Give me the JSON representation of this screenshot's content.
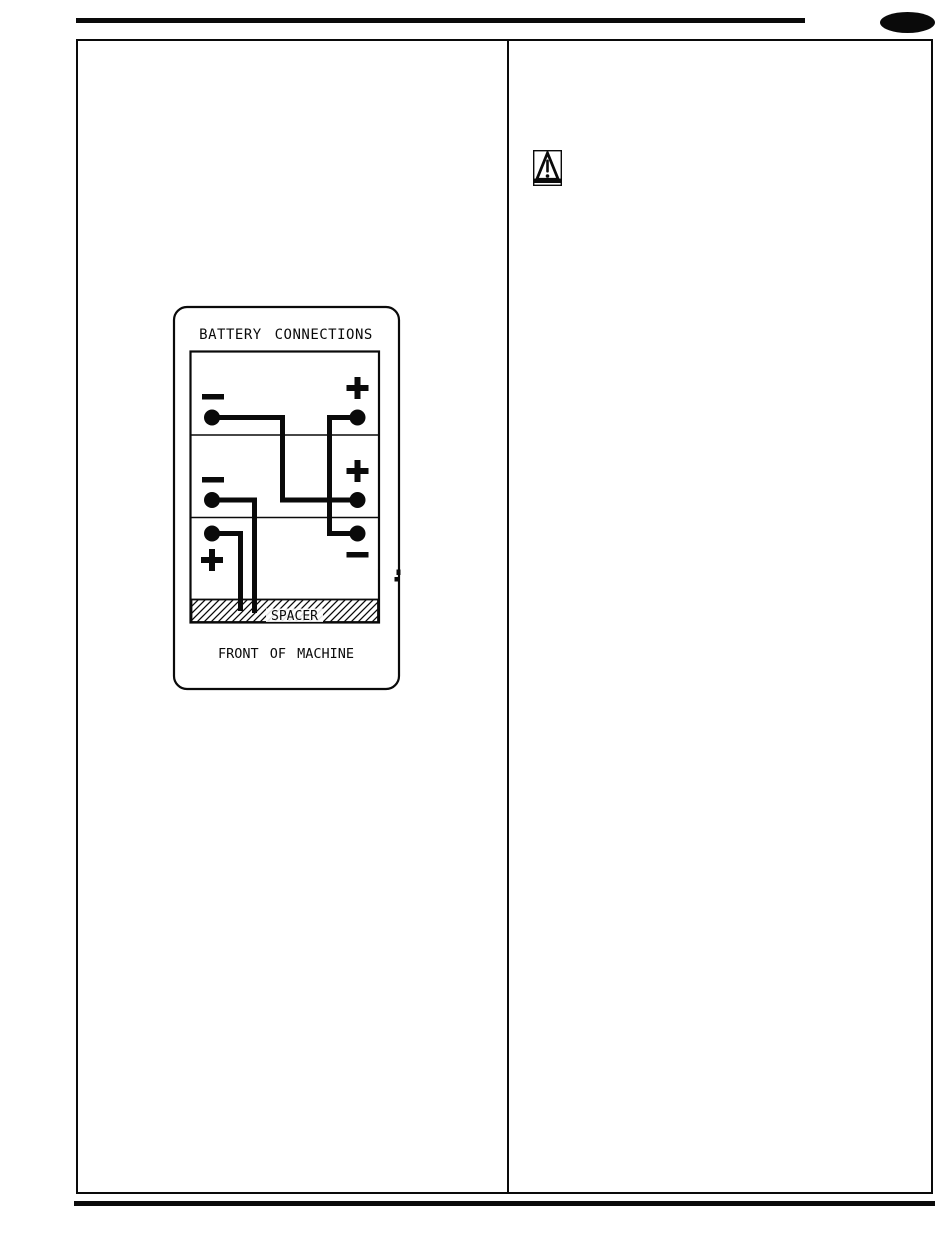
{
  "page": {
    "kind": "scanned manual page",
    "background_color": "#ffffff",
    "ink_color": "#0a0a0a"
  },
  "header": {
    "rule": "thick horizontal line",
    "page_marker_icon": "filled-ellipse"
  },
  "footer": {
    "rule": "thick horizontal line"
  },
  "layout": {
    "columns": 2,
    "left_column_content": "battery connections diagram",
    "right_column_content": "warning icon"
  },
  "right_column": {
    "warning_icon": "warning-triangle-exclamation"
  },
  "diagram": {
    "title": "BATTERY CONNECTIONS",
    "spacer_label": "SPACER",
    "caption": "FRONT OF MACHINE",
    "batteries": [
      {
        "position": "top",
        "left_terminal": "−",
        "right_terminal": "+"
      },
      {
        "position": "middle",
        "left_terminal": "−",
        "right_terminal": "+"
      },
      {
        "position": "bottom",
        "left_terminal": "+",
        "right_terminal": "−"
      }
    ],
    "cables": [
      "top-left (−) across and down to middle-right (+)",
      "top-right (+) down to bottom-right (−)",
      "middle-left (−) down into spacer",
      "bottom-left (+) down into spacer"
    ]
  }
}
